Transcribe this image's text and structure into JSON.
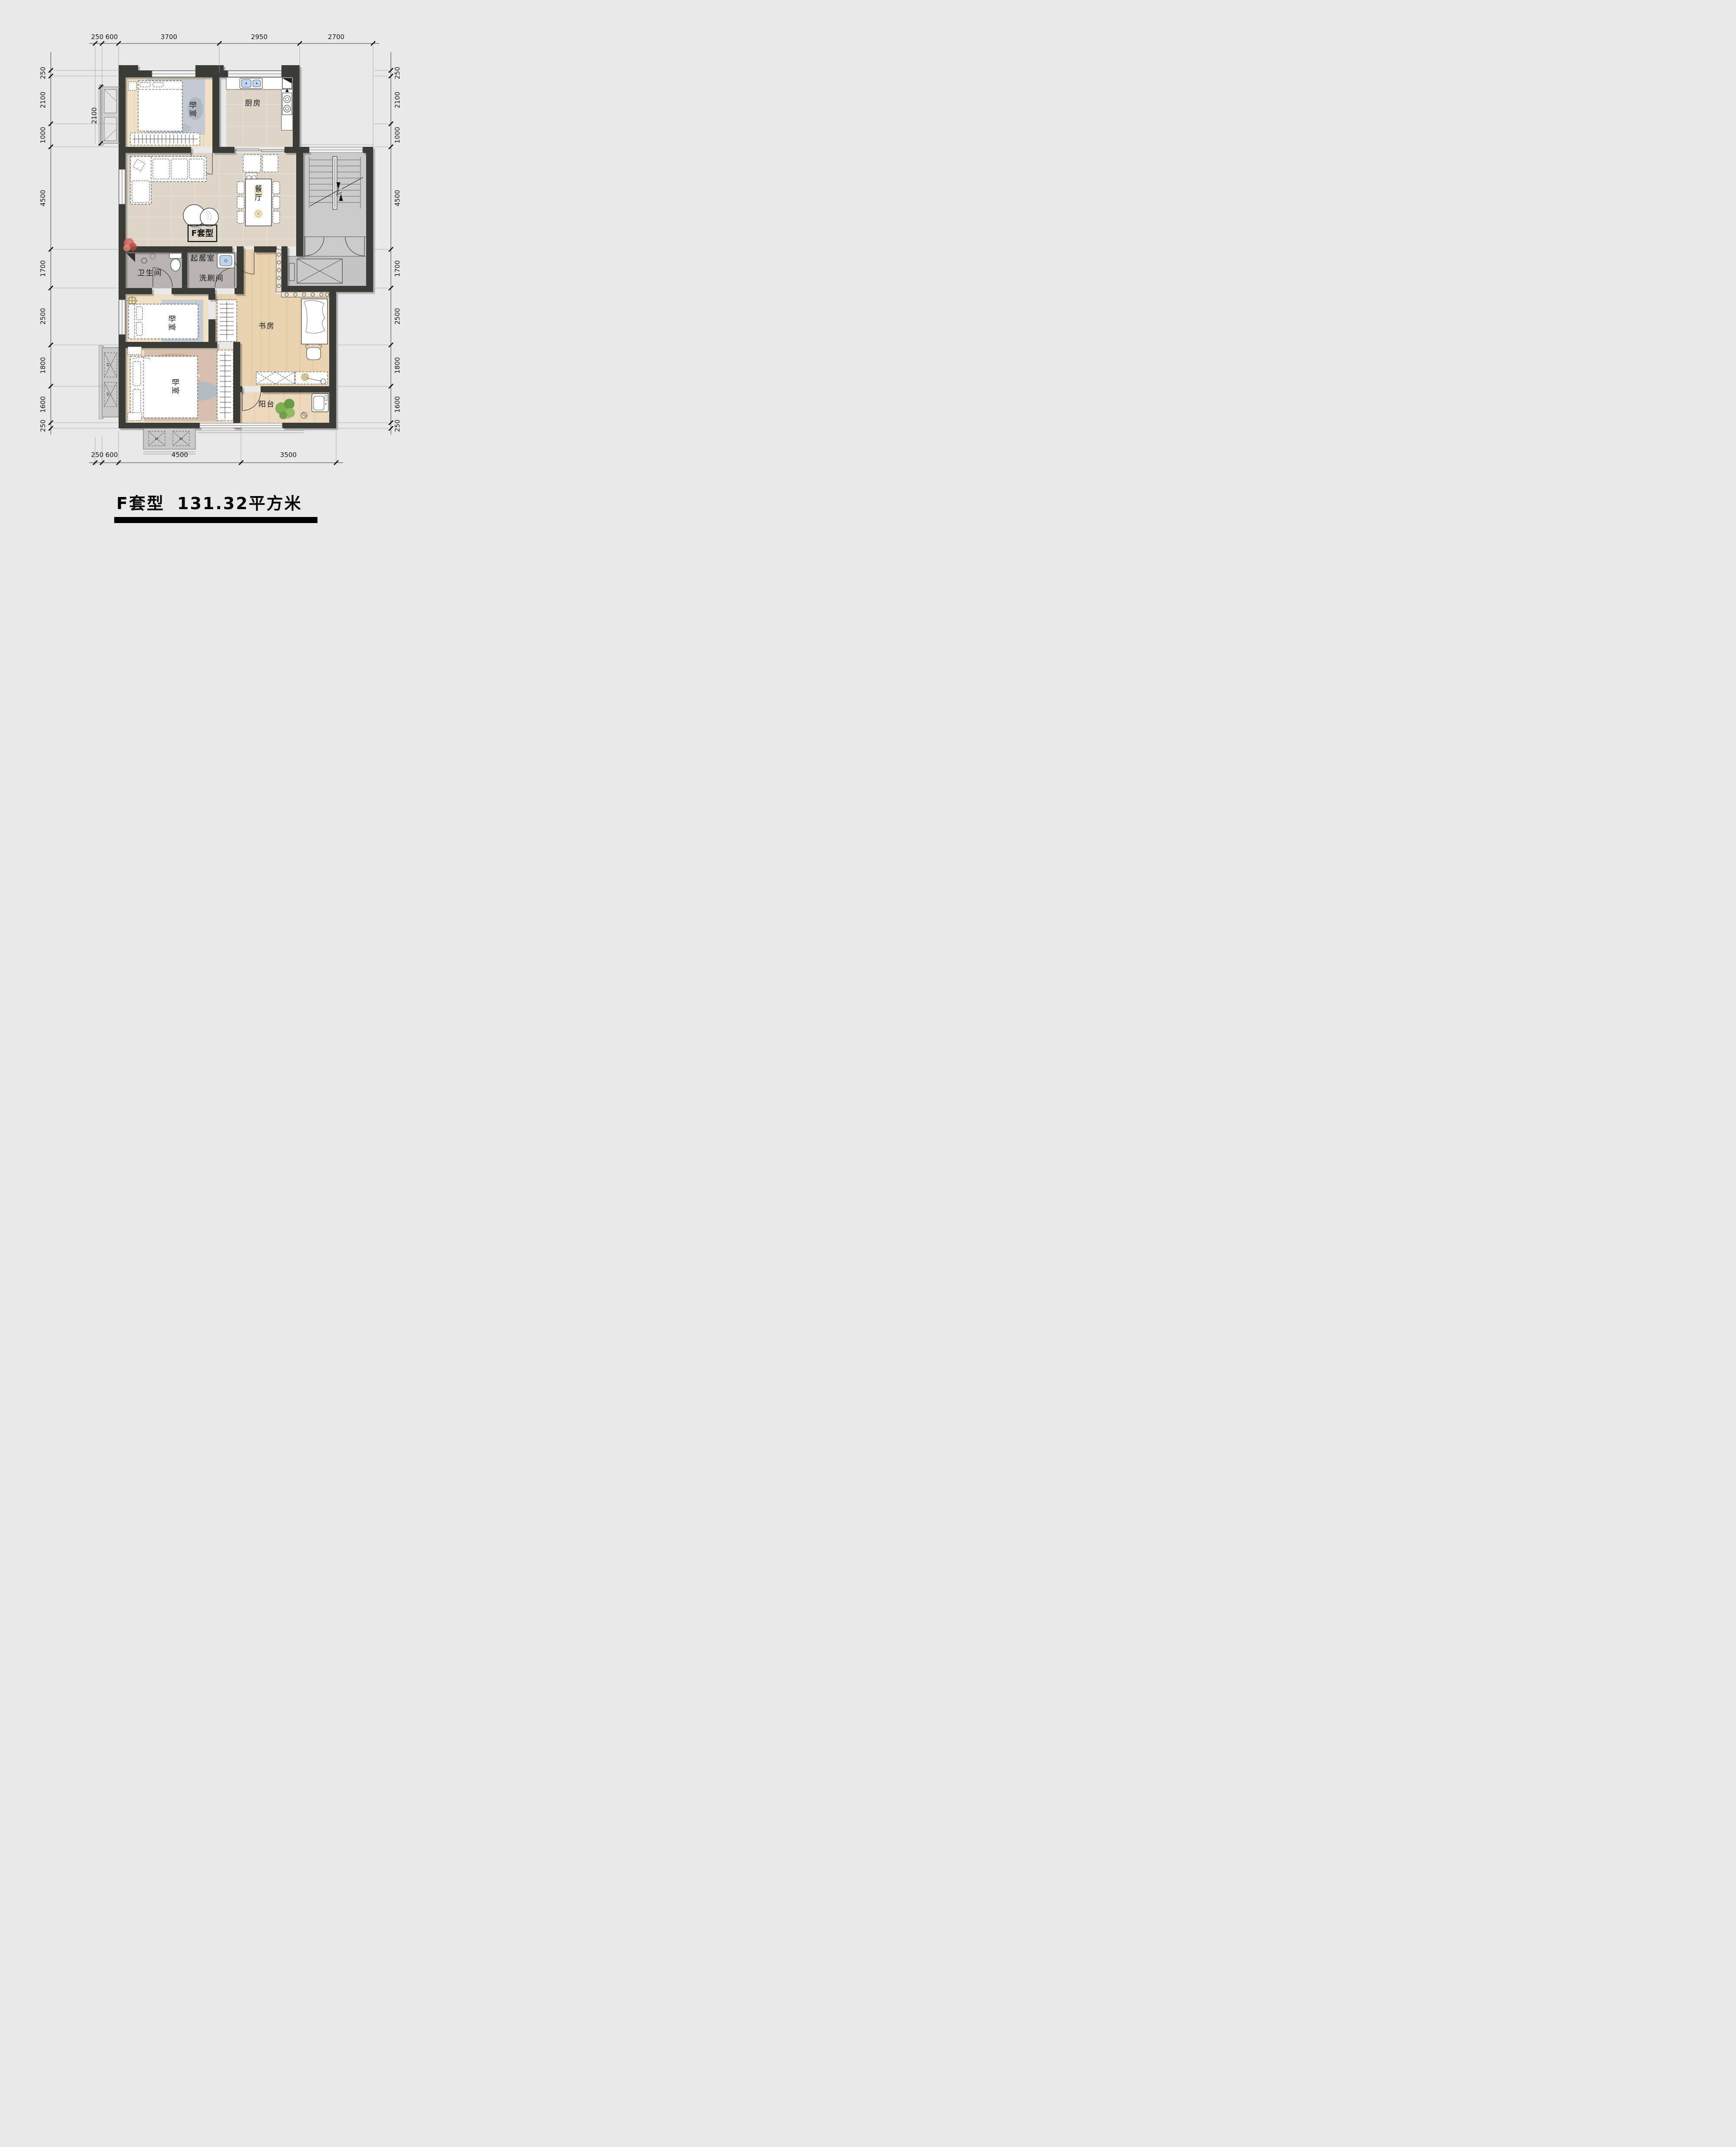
{
  "title": {
    "name": "F套型",
    "area": "131.32平方米"
  },
  "unit_box_label": "F套型",
  "rooms": {
    "bedroom_top": "卧室",
    "kitchen": "厨房",
    "dining": "餐厅",
    "living": "起居室",
    "bathroom": "卫生间",
    "washroom": "洗刷间",
    "bedroom_middle": "卧室",
    "study": "书房",
    "bedroom_bottom": "卧室",
    "balcony": "阳台"
  },
  "ac_unit_label": "KT",
  "dimensions": {
    "top": [
      "250",
      "600",
      "3700",
      "2950",
      "2700"
    ],
    "bottom": [
      "250",
      "600",
      "4500",
      "3500"
    ],
    "left": [
      "250",
      "2100",
      "1000",
      "4500",
      "1700",
      "2500",
      "1800",
      "1600",
      "250"
    ],
    "right": [
      "250",
      "2100",
      "1000",
      "4500",
      "1700",
      "2500",
      "1800",
      "1600",
      "250"
    ],
    "inner_left": "2100"
  },
  "colors": {
    "background": "#e9e9e9",
    "wall": "#3b3b39",
    "marble_floor": "#ddd5c8",
    "wood_bedroom": "#f0e0c6",
    "wood_hall": "#e8d2b0",
    "bath_floor": "#b8b4b0",
    "stair_floor": "#cbcbcb",
    "sink_blue": "#bcd6f2",
    "glow_yellow": "#f3e2a8",
    "plant_green": "#7fae54",
    "plant_red": "#d4685c"
  }
}
